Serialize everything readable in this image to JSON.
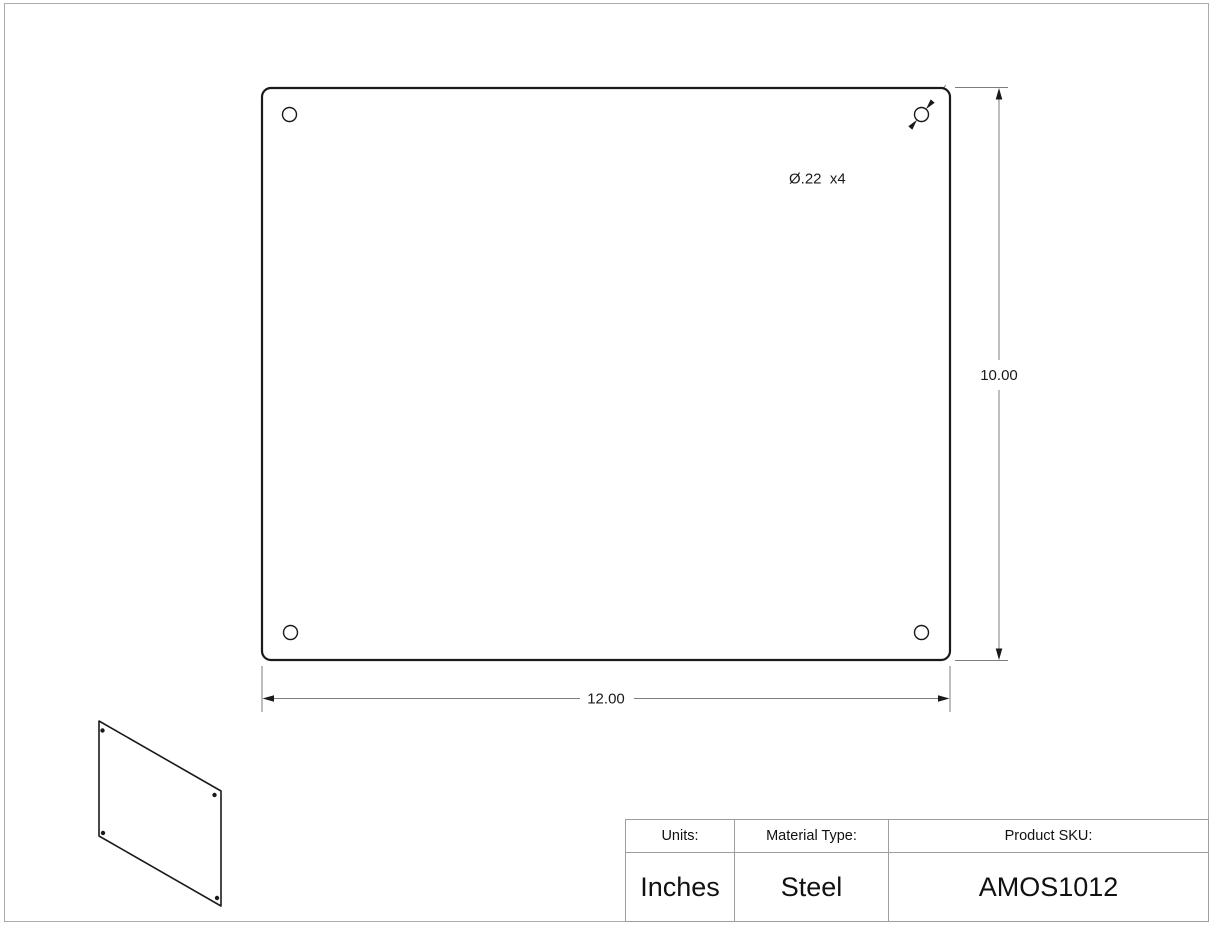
{
  "drawing": {
    "hole_callout": "Ø.22  x4",
    "width_dim": "12.00",
    "height_dim": "10.00"
  },
  "title_block": {
    "headers": [
      "Units:",
      "Material Type:",
      "Product SKU:"
    ],
    "values": [
      "Inches",
      "Steel",
      "AMOS1012"
    ]
  },
  "colors": {
    "outline": "#1a1a1a",
    "dimension_line": "#7d7d7d",
    "table_border": "#9e9e9e",
    "page_border": "#ababab",
    "background": "#ffffff"
  }
}
